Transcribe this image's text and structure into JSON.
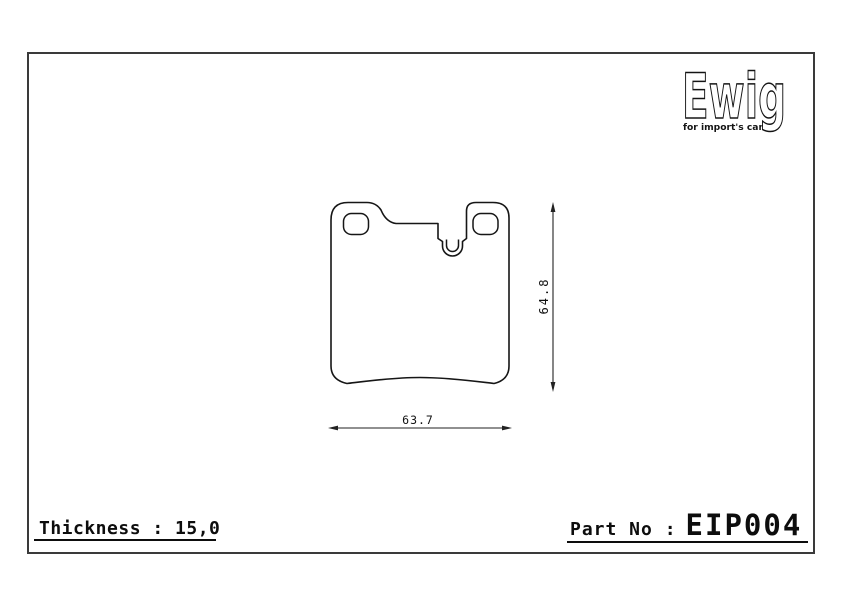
{
  "colors": {
    "background": "#ffffff",
    "frame_border": "#3a3a3a",
    "line_color": "#161616",
    "text_color": "#0d0d0d"
  },
  "logo": {
    "brand": "Ewig",
    "tagline": "for import's car"
  },
  "drawing": {
    "subject": "brake-pad-outline",
    "dim_height": "64.8",
    "dim_width": "63.7"
  },
  "footer": {
    "thickness_label": "Thickness : 15,0",
    "part_label": "Part No :",
    "part_number": "EIP004"
  }
}
